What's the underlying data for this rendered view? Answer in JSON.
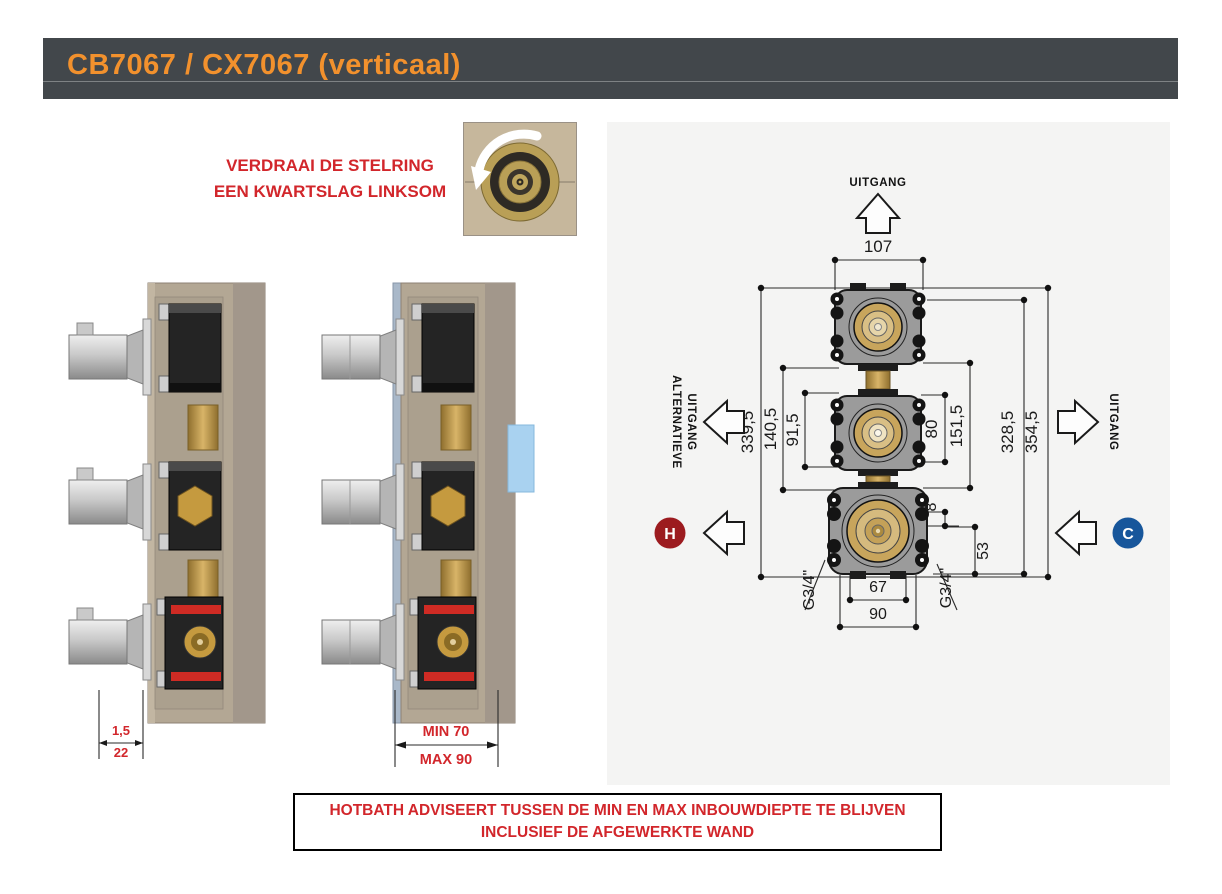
{
  "header": {
    "title": "CB7067 / CX7067 (verticaal)"
  },
  "instruction": {
    "line1": "VERDRAAI DE STELRING",
    "line2": "EEN KWARTSLAG LINKSOM"
  },
  "left_photo": {
    "dim_top": "1,5",
    "dim_bottom": "22"
  },
  "right_photo": {
    "dim_min": "MIN 70",
    "dim_max": "MAX 90"
  },
  "drawing": {
    "outlet_top": "UITGANG",
    "outlet_left_line1": "ALTERNATIEVE",
    "outlet_left_line2": "UITGANG",
    "outlet_right": "UITGANG",
    "hot_label": "H",
    "cold_label": "C",
    "dims": {
      "d107": "107",
      "d339_5": "339,5",
      "d140_5": "140,5",
      "d91_5": "91,5",
      "d80": "80",
      "d151_5": "151,5",
      "d328_5": "328,5",
      "d354_5": "354,5",
      "d67": "67",
      "d90": "90",
      "d53": "53",
      "d8": "8",
      "thread_left": "G3/4\"",
      "thread_right": "G3/4\""
    },
    "colors": {
      "hot": "#9c1b1f",
      "cold": "#17569b"
    }
  },
  "advice": {
    "line1": "HOTBATH ADVISEERT TUSSEN DE MIN EN MAX INBOUWDIEPTE TE BLIJVEN",
    "line2": "INCLUSIEF DE AFGEWERKTE WAND"
  }
}
